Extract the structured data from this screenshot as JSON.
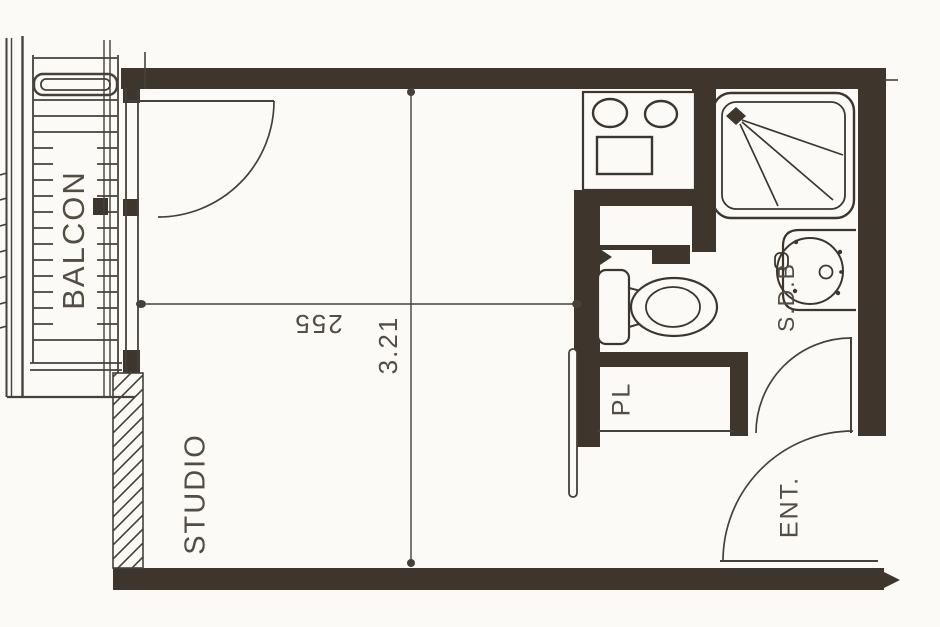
{
  "plan": {
    "type": "studio apartment floor plan",
    "colors": {
      "paper": "#fbfaf6",
      "wall": "#3e352c",
      "line": "#45403a",
      "text": "#544d44"
    },
    "labels": {
      "balcony": "BALCON",
      "studio": "STUDIO",
      "closet": "PL",
      "bathroom": "S.D.B",
      "entrance": "ENT."
    },
    "dimensions": {
      "studio_width": "255",
      "studio_depth": "3.21"
    }
  }
}
